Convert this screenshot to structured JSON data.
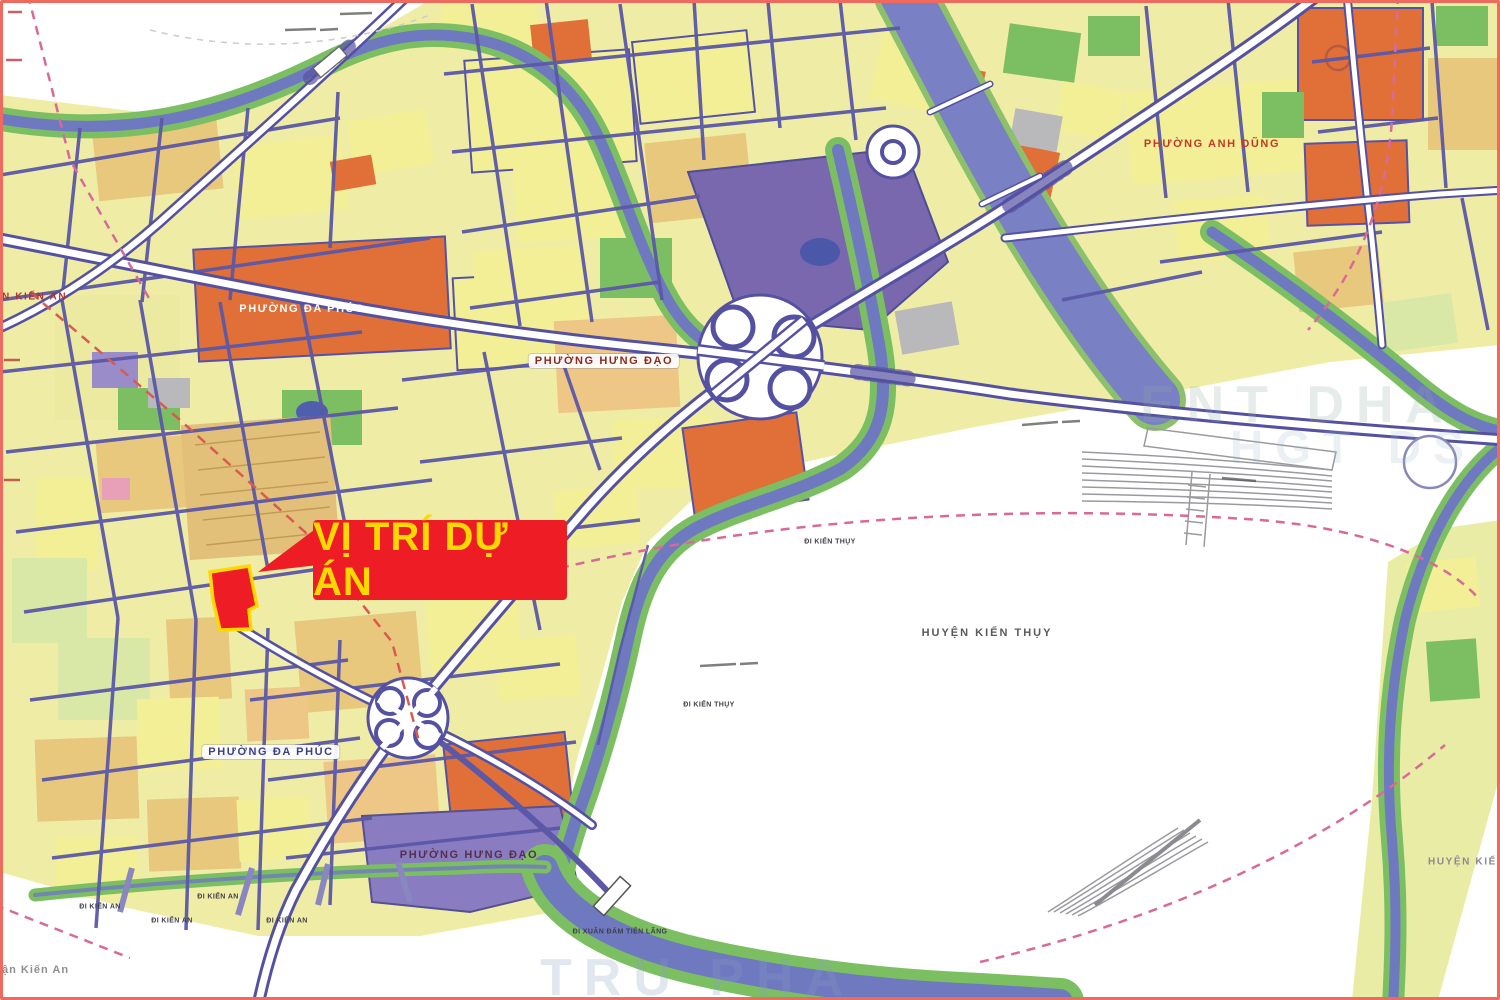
{
  "callout": {
    "text": "VỊ TRÍ DỰ ÁN"
  },
  "labels": [
    {
      "id": "phuong-da-phuc-north",
      "text": "PHƯỜNG ĐA PHÚC"
    },
    {
      "id": "phuong-hung-dao-north",
      "text": "PHƯỜNG HƯNG ĐẠO"
    },
    {
      "id": "phuong-anh-dung",
      "text": "PHƯỜNG ANH DŨNG"
    },
    {
      "id": "huyen-kien-thuy-center",
      "text": "HUYỆN KIẾN THỤY"
    },
    {
      "id": "phuong-da-phuc-south",
      "text": "PHƯỜNG ĐA PHÚC"
    },
    {
      "id": "phuong-hung-dao-south",
      "text": "PHƯỜNG HƯNG ĐẠO"
    },
    {
      "id": "huyen-kien-thuy-right",
      "text": "HUYỆN KIẾN THỤY"
    },
    {
      "id": "quan-kien-an-left",
      "text": "N KIẾN AN"
    },
    {
      "id": "quan-kien-an-bottom",
      "text": "ận Kiến An"
    }
  ],
  "road_labels": [
    {
      "text": "ĐI KIẾN AN"
    },
    {
      "text": "ĐI KIẾN AN"
    },
    {
      "text": "ĐI KIẾN AN"
    },
    {
      "text": "ĐI KIẾN AN"
    },
    {
      "text": "ĐI XUÂN ĐÁM TIÊN LÃNG"
    },
    {
      "text": "ĐI KIẾN THỤY"
    },
    {
      "text": "ĐI KIẾN THỤY"
    }
  ],
  "watermarks": [
    {
      "text": "ENT DHA"
    },
    {
      "text": "HGT DS"
    },
    {
      "text": "TRU PHA"
    }
  ],
  "colors": {
    "frame": "#ef6a5e",
    "highlight_red": "#ee1c24",
    "highlight_outline": "#ffd800",
    "callout_bg": "#ee1c24",
    "callout_text": "#ffd800",
    "water_blue": "#6f79c0",
    "park_green": "#7cbf62",
    "residential_yellow": "#f3ef96",
    "mixed_orange": "#e06f38",
    "institutional_purple": "#7a68ae",
    "road_blue": "#5551a2",
    "boundary_pink": "#d86a9a"
  }
}
